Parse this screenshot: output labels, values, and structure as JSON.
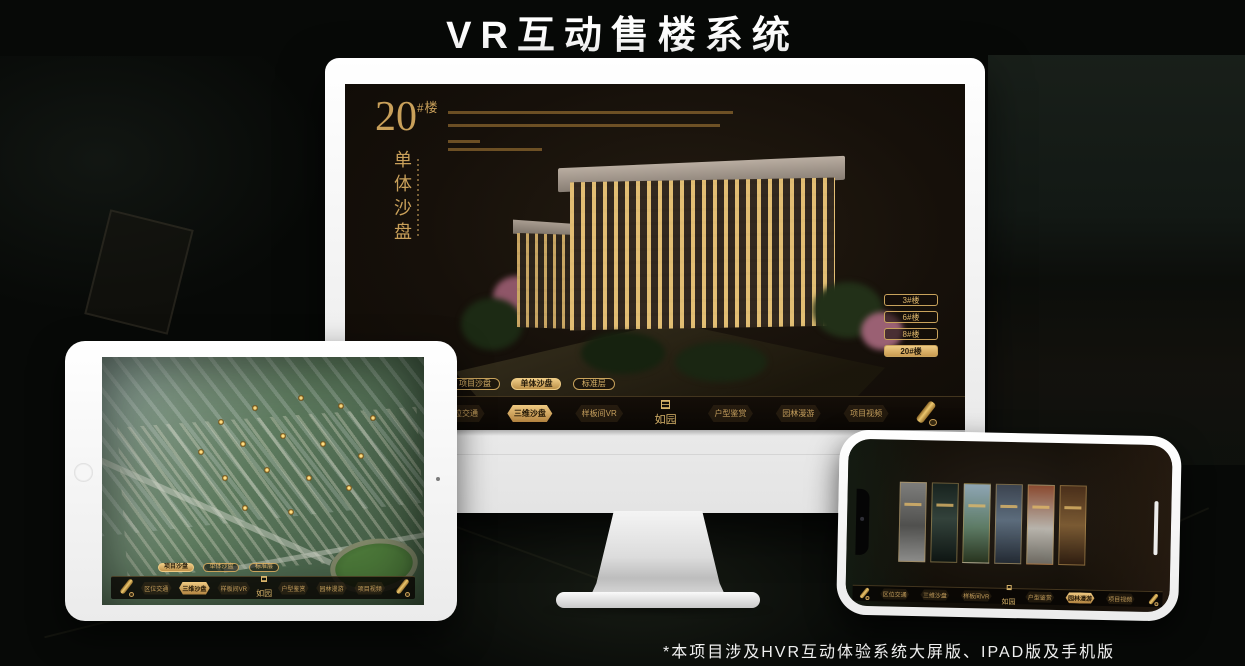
{
  "page": {
    "title": "VR互动售楼系统",
    "footnote": "*本项目涉及HVR互动体验系统大屏版、IPAD版及手机版"
  },
  "colors": {
    "gold": "#c9a35c",
    "gold_bright": "#eecb84",
    "screen_dark": "#16100a",
    "white_device": "#ffffff"
  },
  "nav": {
    "logo": "如园",
    "items": [
      "区位交通",
      "三维沙盘",
      "样板间VR",
      "户型鉴赏",
      "园林漫游",
      "项目视频"
    ]
  },
  "tabs": [
    "项目沙盘",
    "单体沙盘",
    "标准层"
  ],
  "monitor_app": {
    "block_number": "20",
    "block_suffix": "#楼",
    "section_title": "单体沙盘",
    "floor_buttons": [
      "3#楼",
      "6#楼",
      "8#楼",
      "20#楼"
    ],
    "active_floor": "20#楼",
    "active_tab": "单体沙盘",
    "active_nav": "三维沙盘"
  },
  "ipad_app": {
    "active_tab": "项目沙盘",
    "active_nav": "三维沙盘"
  },
  "phone_app": {
    "active_nav": "园林漫游",
    "gallery_panel_count": 6
  }
}
